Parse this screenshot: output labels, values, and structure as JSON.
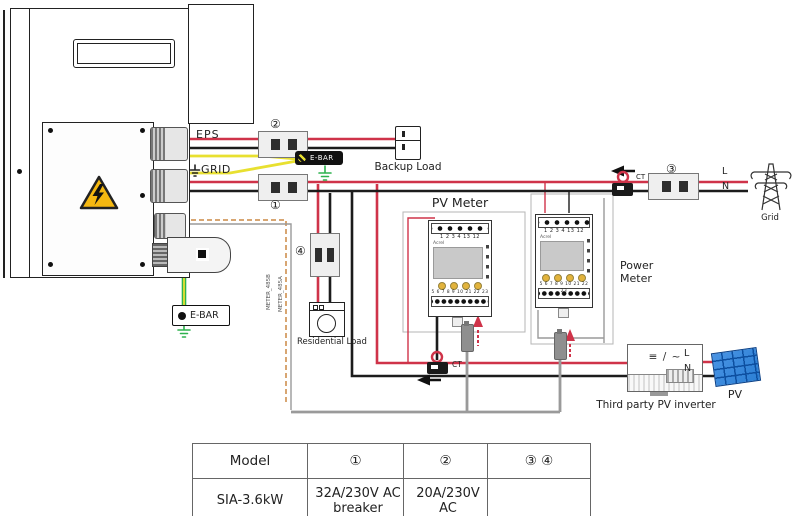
{
  "colors": {
    "wire_live": "#cf3349",
    "wire_neutral": "#1c1c1c",
    "wire_pe_yellow": "#e8e030",
    "wire_pe_green": "#2eb24e",
    "wire_comm_gray": "#9a9a9a",
    "wire_rs485_orange": "#cc8844",
    "warning_yellow": "#f5b811",
    "pv_blue": "#2b7fd4"
  },
  "labels": {
    "eps": "EPS",
    "grid_port": "GRID",
    "ebar_top": "E-BAR",
    "ebar_bottom": "E-BAR",
    "backup_load": "Backup Load",
    "residential_load": "Residential Load",
    "pv_meter_title": "PV Meter",
    "power_meter_title": "Power Meter",
    "grid": "Grid",
    "ct1": "CT",
    "ct2": "CT",
    "l_grid": "L",
    "n_grid": "N",
    "l_pv": "L",
    "n_pv": "N",
    "meter_485b": "METER_485B",
    "meter_485a": "METER_485A",
    "third_party_inverter": "Third party PV inverter",
    "pv": "PV",
    "dc_ac_symbol": "≡ / ~",
    "breaker1": "①",
    "breaker2": "②",
    "breaker3": "③",
    "breaker4": "④"
  },
  "meters": {
    "pv_meter": {
      "brand": "Acrel",
      "top_terminals": "1 2 3 4 13 12",
      "bottom_terminals": "5 6 7 8 9 10 21 22 23"
    },
    "power_meter": {
      "brand": "Acrel",
      "top_terminals": "1 2 3 4 13 12",
      "bottom_terminals": "5 6 7 8 9 10 21 22 23"
    }
  },
  "table": {
    "headers": [
      "Model",
      "①",
      "②",
      "③ ④"
    ],
    "row": {
      "model": "SIA-3.6kW",
      "breaker1_line1": "32A/230V AC",
      "breaker1_line2": "breaker",
      "breaker2_line1": "20A/230V AC",
      "breaker2_line2": "breaker",
      "breaker34": ""
    }
  }
}
